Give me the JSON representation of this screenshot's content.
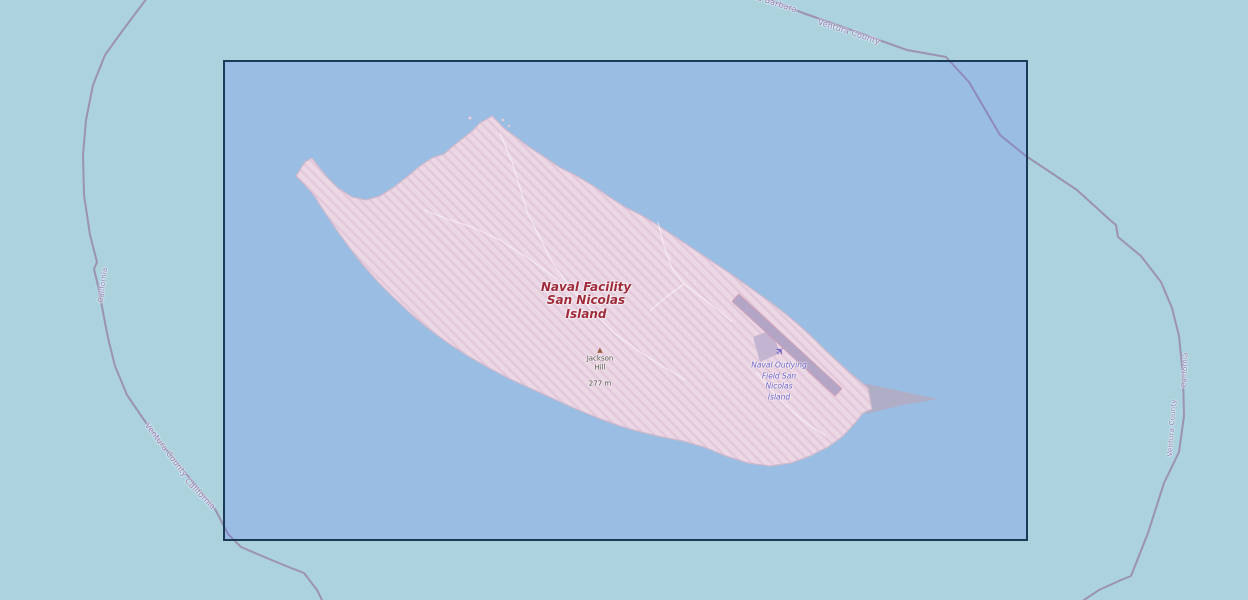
{
  "map": {
    "labels": {
      "military_area": "Naval Facility\nSan Nicolas\nIsland",
      "peak_name": "Jackson\nHill",
      "peak_elevation": "277 m",
      "airfield": "Naval Outlying\nField San\nNicolas\nIsland",
      "boundary": {
        "top_fragment": "Santa Barbara",
        "top_county": "Ventura County",
        "west_state": "California",
        "southwest_county": "Ventura County",
        "southwest_state": "California",
        "east_state": "California",
        "east_county": "Ventura County"
      }
    },
    "icons": {
      "peak_glyph": "▲",
      "airplane_glyph": "✈"
    },
    "colors": {
      "water_outside": "#abd2dd",
      "selection_tint": "rgba(90,110,255,0.20)",
      "selection_border": "#1a3a57",
      "island_fill": "#ecd8e5",
      "island_hatch": "#e2c8da",
      "island_outline": "#cdb8cc",
      "sand_spit": "#b2abc2",
      "runway": "#b3a5c6",
      "runway_edge": "#d0a2b8",
      "apron": "#c3b4d1",
      "track": "rgba(255,255,255,0.55)",
      "boundary_line": "#9a8bad",
      "boundary_label": "#8578b2",
      "military_label": "#a02a3a",
      "airfield_label": "#6b5ec5",
      "peak_label": "#4f4a44",
      "peak_icon": "#9c5d3a",
      "islet": "#e9d5e3"
    }
  }
}
